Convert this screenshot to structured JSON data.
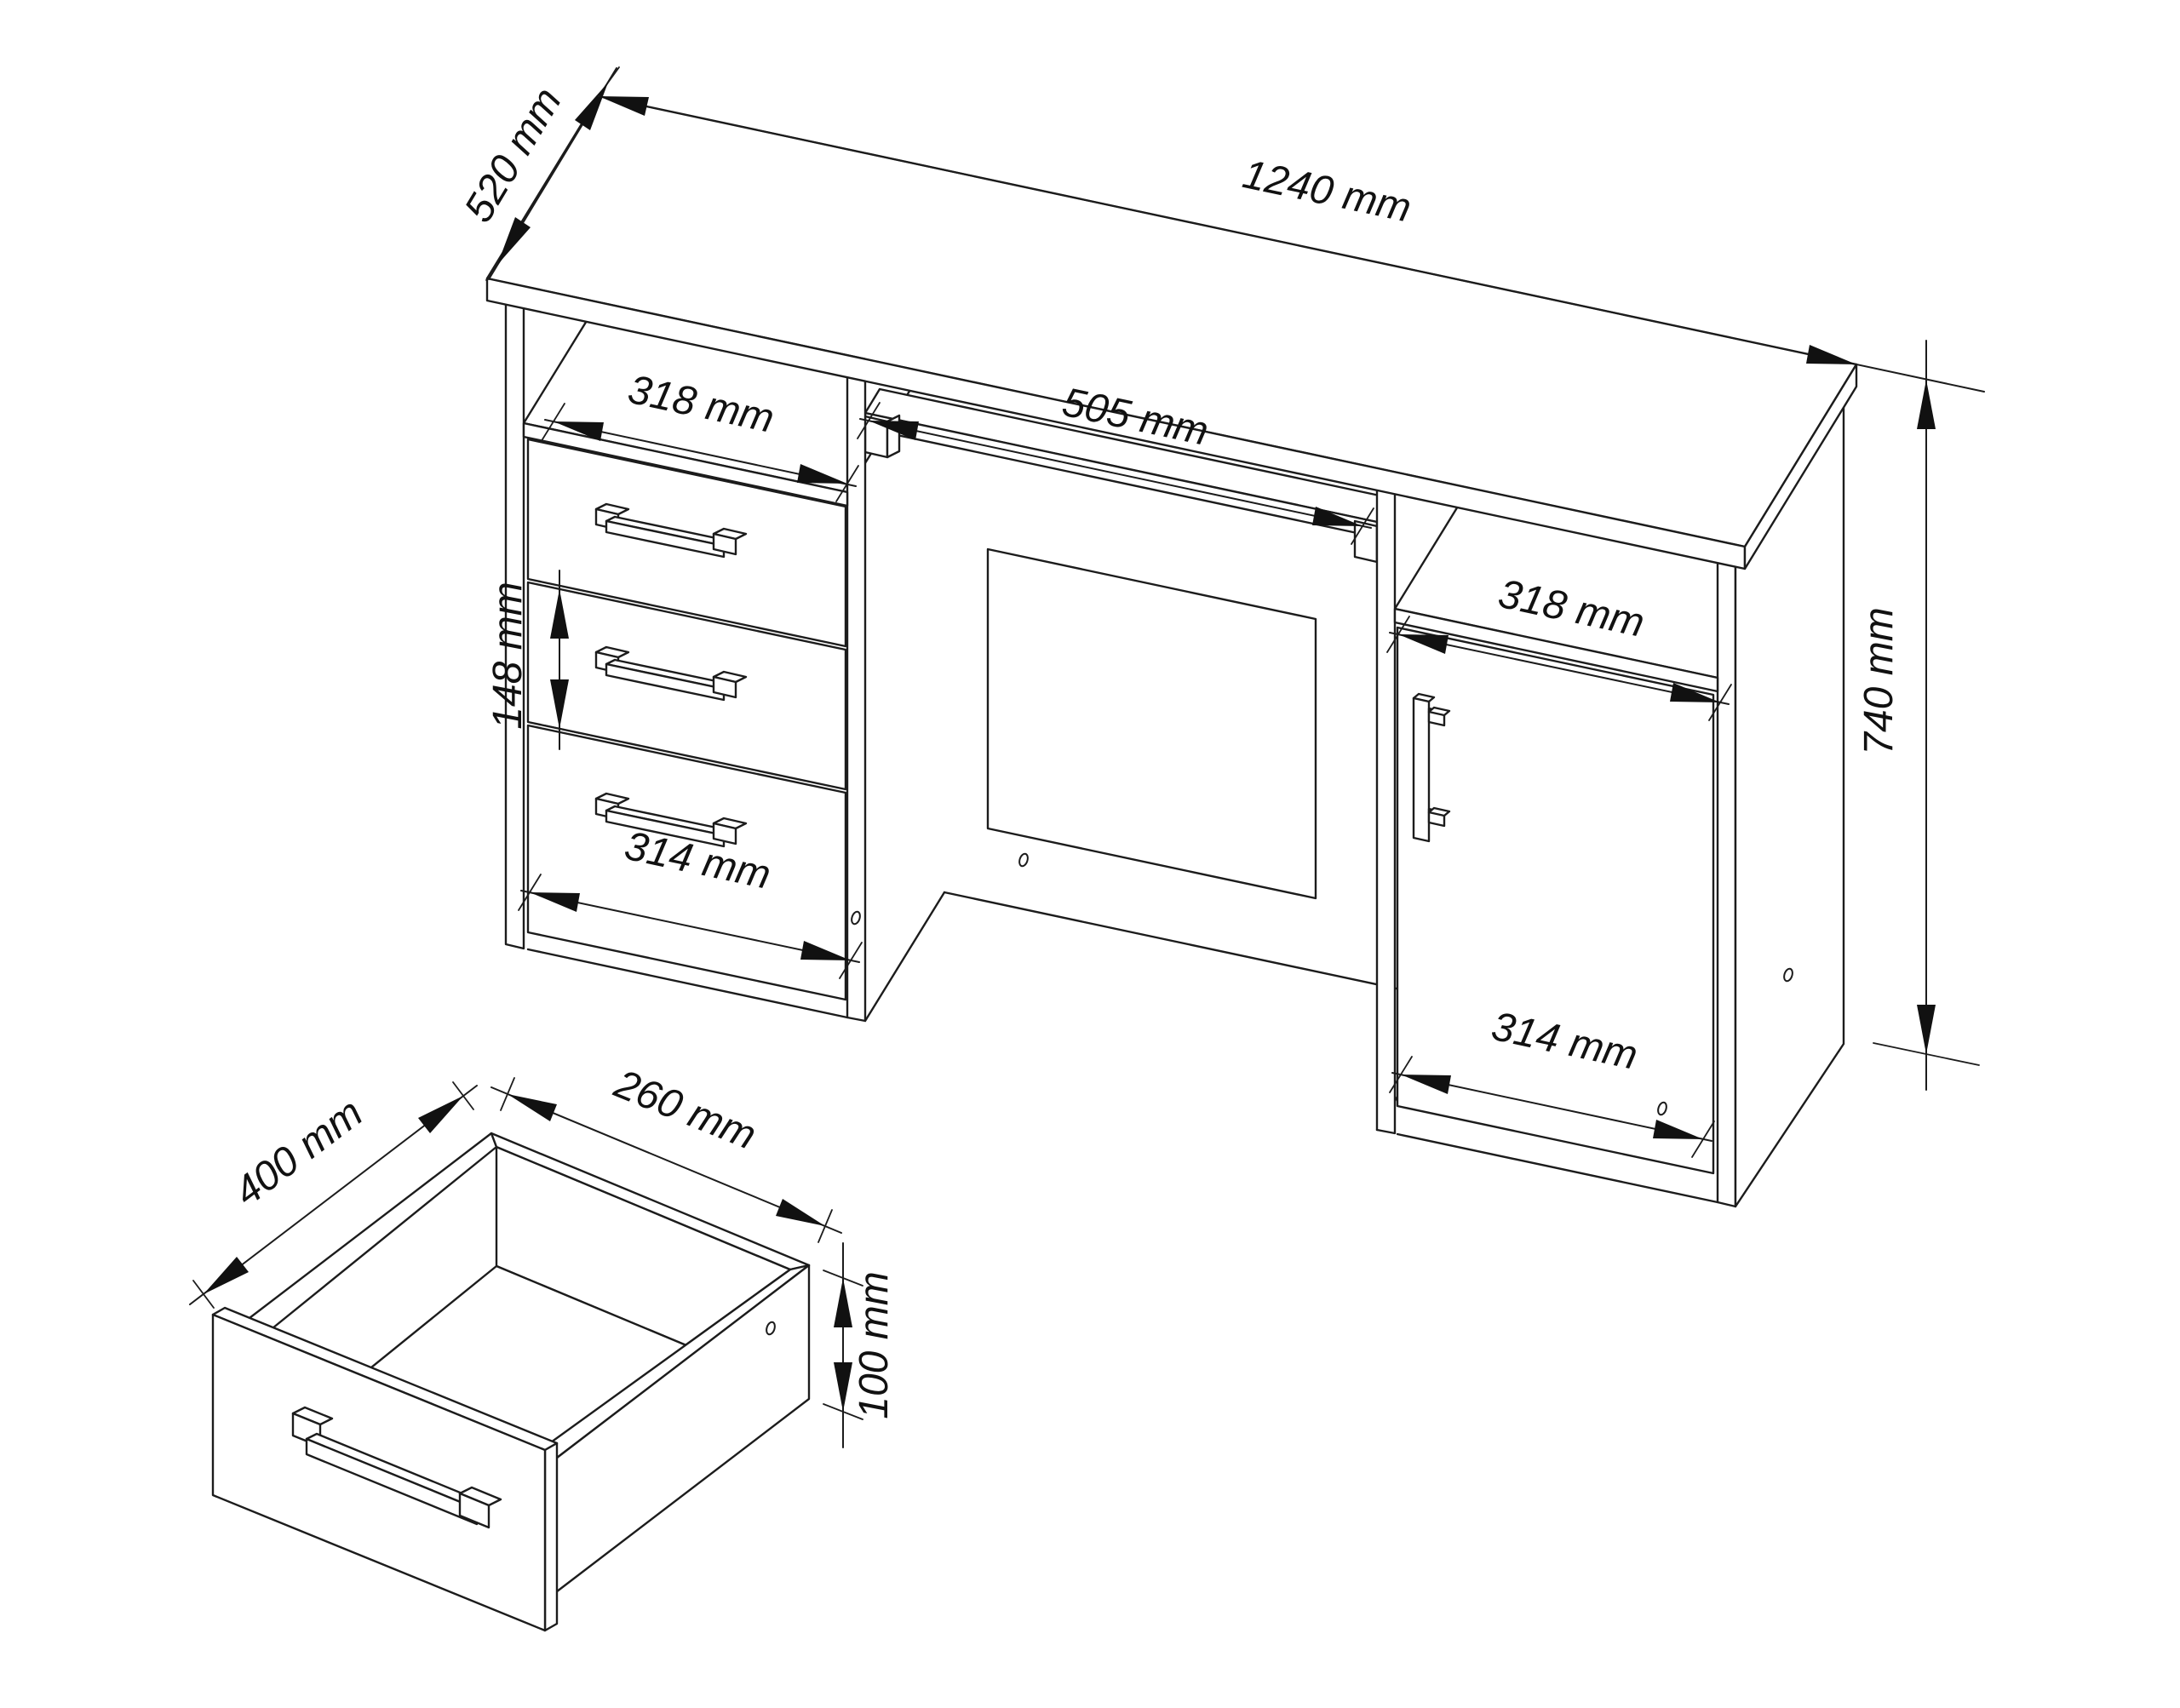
{
  "page": {
    "background_color": "#ffffff",
    "line_color": "#1c1c1c"
  },
  "diagram": {
    "type": "furniture-technical-drawing",
    "subject": "computer desk with three drawers, keyboard tray and cabinet door, plus drawer detail view",
    "desk": {
      "dimensions": {
        "depth": "520 mm",
        "width": "1240 mm",
        "left_compartment_width": "318 mm",
        "keyboard_tray_width": "505 mm",
        "drawer_front_height": "148 mm",
        "drawer_front_width": "314 mm",
        "right_compartment_width": "318 mm",
        "height": "740 mm",
        "door_width": "314 mm"
      }
    },
    "drawer_detail": {
      "dimensions": {
        "depth": "400 mm",
        "inner_width": "260 mm",
        "inner_height": "100 mm"
      }
    }
  }
}
